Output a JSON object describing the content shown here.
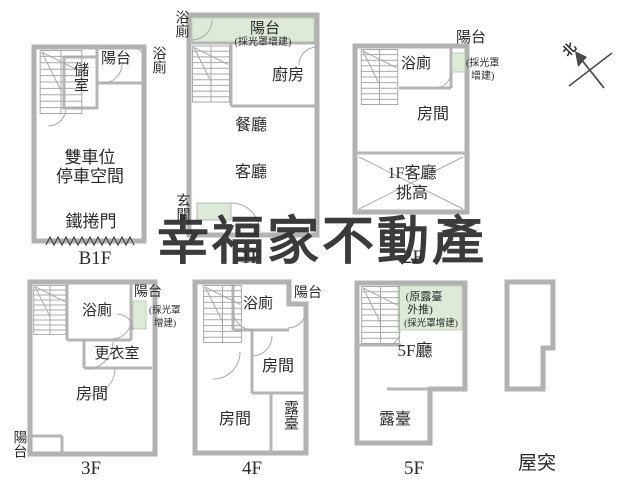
{
  "watermark_text": "幸福家不動產",
  "compass": {
    "north": "北"
  },
  "colors": {
    "wall": "#b2b2b2",
    "highlight_green": "#dcead7",
    "watermark": "#a59898",
    "label_text": "#2b2b2b"
  },
  "floors": {
    "b1f": {
      "name": "B1F",
      "balcony": "陽台",
      "storage": "儲室",
      "bathroom": "浴廁",
      "parking_line1": "雙車位",
      "parking_line2": "停車空間",
      "rolling_door": "鐵捲門"
    },
    "f1": {
      "name": "1F",
      "bathroom": "浴廁",
      "balcony": "陽台",
      "balcony_note": "(採光罩增建)",
      "kitchen": "廚房",
      "dining": "餐廳",
      "living": "客廳",
      "foyer": "玄關"
    },
    "f2": {
      "name": "2F",
      "balcony": "陽台",
      "bathroom": "浴廁",
      "note_line1": "(採光罩",
      "note_line2": "增建)",
      "room": "房間",
      "void_line1": "1F客廳",
      "void_line2": "挑高"
    },
    "f3": {
      "name": "3F",
      "bathroom": "浴廁",
      "balcony_top": "陽台",
      "note_line1": "(採光罩",
      "note_line2": "增建)",
      "closet": "更衣室",
      "room": "房間",
      "balcony_bottom": "陽台"
    },
    "f4": {
      "name": "4F",
      "bathroom": "浴廁",
      "balcony": "陽台",
      "room_upper": "房間",
      "room_lower": "房間",
      "terrace": "露臺"
    },
    "f5": {
      "name": "5F",
      "note_line1": "(原露臺",
      "note_line2": "外推)",
      "note_line3": "(採光罩增建)",
      "hall": "5F廳",
      "terrace": "露臺"
    },
    "roof": {
      "name": "屋突"
    }
  }
}
